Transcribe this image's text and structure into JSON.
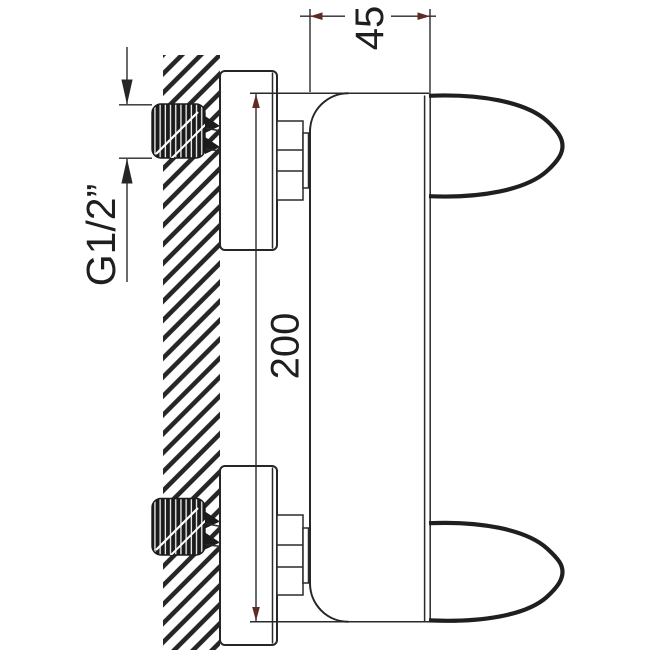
{
  "labels": {
    "dim_depth": "45",
    "dim_height": "200",
    "dim_thread": "G1/2”"
  },
  "colors": {
    "line": "#262626",
    "dim_arrow": "#5f2b26",
    "thread_fill": "#1b1b1b",
    "background": "#ffffff"
  }
}
